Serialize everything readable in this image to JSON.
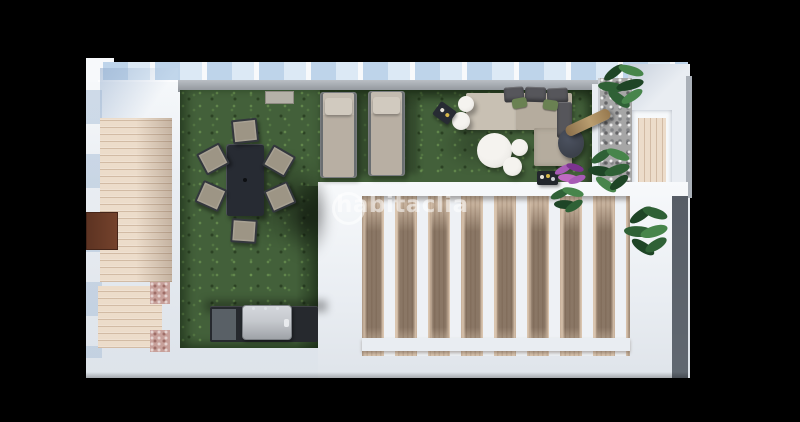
{
  "watermark": {
    "text": "habitaclia"
  },
  "colors": {
    "bg-black": "#000000",
    "wall-white": "#e9edf2",
    "wall-bright": "#f7f9fb",
    "wall-shade": "#d6dce3",
    "glass-blue": "#bed4ea",
    "coping-gray": "#8d9298",
    "lawn-green": "#43603a",
    "wood-deck": "#ecdcca",
    "pergola-wood": "#dac5af",
    "pergola-slat": "#eef1f5",
    "tile-pink": "#c7a09a",
    "cabinet-brown": "#74422c",
    "table-dark": "#272b33",
    "chair-seat": "#9d9585",
    "chair-frame": "#33373d",
    "lounger-body": "#b8afa3",
    "lounger-pillow": "#d1cabf",
    "sofa-base": "#b5ac9e",
    "sofa-platform": "#c8c0b3",
    "cushion-dark": "#56565b",
    "pillow-green": "#6a8152",
    "round-white": "#efede9",
    "gravel-gray": "#a6a6a6",
    "parasol-tan": "#b99d6f",
    "parasol-base": "#3c414b",
    "bbq-dark": "#26292e",
    "bbq-steel": "#c6c9ce",
    "strip-dark": "#616871",
    "plant-green": "#2f6136",
    "plant-green-light": "#47854b",
    "plant-green-dark": "#1e4526",
    "plant-purple": "#a75bb5",
    "plant-purple-dark": "#7c3390",
    "watermark-white": "rgba(255,255,255,0.55)"
  },
  "scene": {
    "items": [
      "glass-railing",
      "artificial-lawn",
      "dining-table",
      "dining-chair",
      "sun-lounger",
      "corner-sofa",
      "coffee-table",
      "pouf",
      "parasol",
      "bbq-grill",
      "pergola",
      "wood-deck",
      "gravel-bed",
      "plant",
      "watermark"
    ]
  }
}
